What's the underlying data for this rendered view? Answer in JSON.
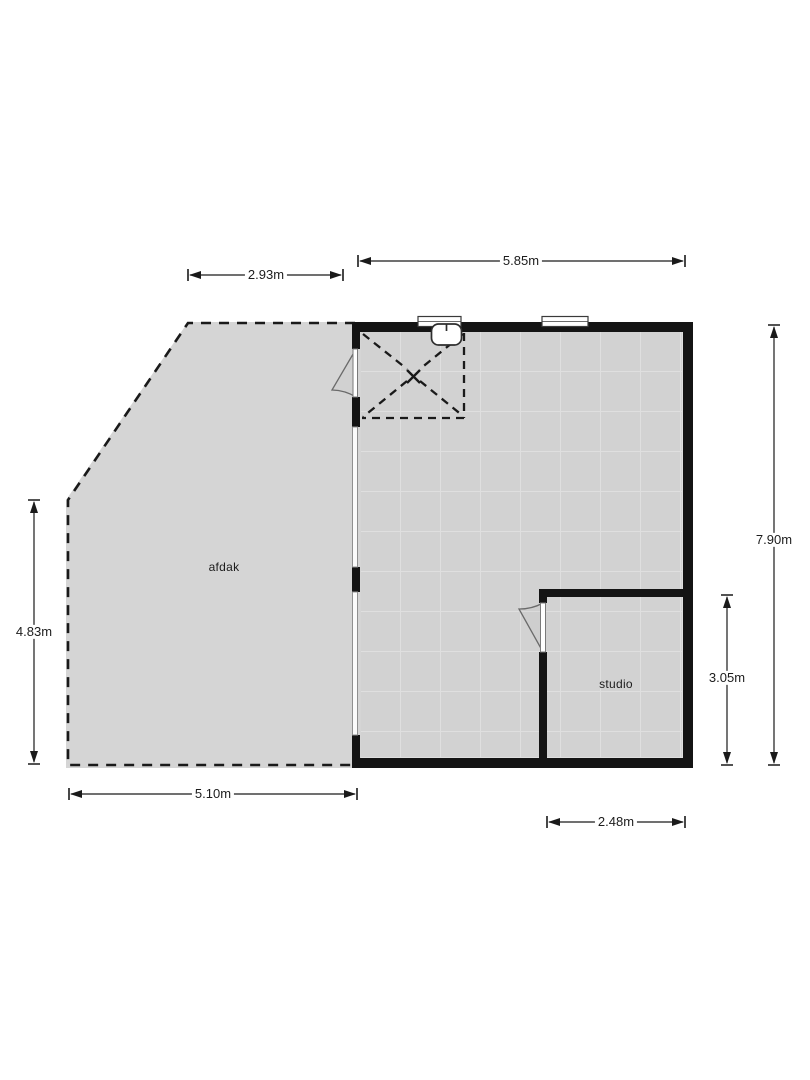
{
  "plan": {
    "type": "floorplan",
    "rooms": {
      "afdak": {
        "label": "afdak"
      },
      "studio": {
        "label": "studio"
      }
    },
    "dimensions": {
      "afdak_top": {
        "label": "2.93m",
        "orientation": "horizontal"
      },
      "building_top": {
        "label": "5.85m",
        "orientation": "horizontal"
      },
      "building_right": {
        "label": "7.90m",
        "orientation": "vertical"
      },
      "studio_right": {
        "label": "3.05m",
        "orientation": "vertical"
      },
      "afdak_left": {
        "label": "4.83m",
        "orientation": "vertical"
      },
      "afdak_bottom": {
        "label": "5.10m",
        "orientation": "horizontal"
      },
      "studio_bottom": {
        "label": "2.48m",
        "orientation": "horizontal"
      }
    },
    "fixtures": {
      "basin": "wash-basin",
      "skylight": "dashed-square-with-x",
      "doors": [
        "door-to-afdak",
        "door-to-studio"
      ],
      "windows": [
        "top-window-left",
        "top-window-right",
        "left-glass-upper",
        "left-glass-lower"
      ]
    }
  },
  "colors": {
    "wall": "#141414",
    "floor": "#d2d2d2",
    "floor-grid": "#dfdfdf",
    "afdak": "#d5d5d5",
    "line": "#1a1a1a",
    "fixture": "#555555",
    "label": "#1c1c1c"
  }
}
